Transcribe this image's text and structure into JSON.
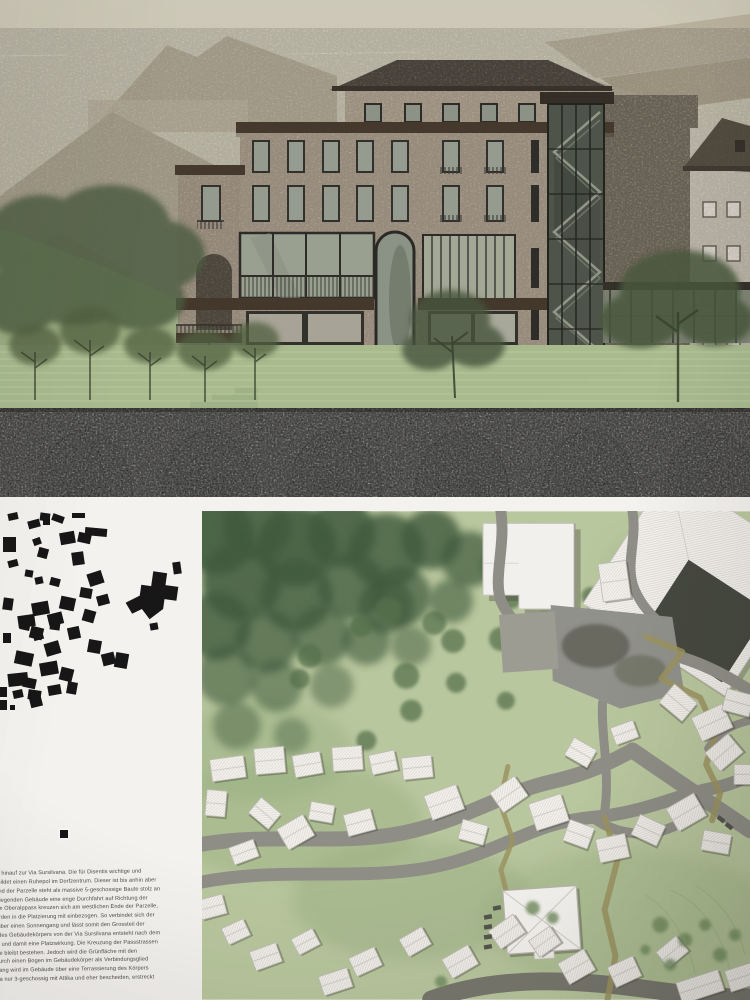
{
  "board": {
    "panels": {
      "top": "building-street-elevation-rendering",
      "bottom_left": "figure-ground-village-diagram",
      "bottom_right": "site-plan-rendering",
      "bottom_text": "project-description-german"
    }
  },
  "colors": {
    "sky": "#cac5b2",
    "stone_facade": "#b4a795",
    "cornice_dark": "#44392c",
    "window_glass": "#99a090",
    "terrace_green": "#a8ba8e",
    "stone_wall_dark": "#504f4a",
    "paper_white": "#f4f2ef",
    "plan_green": "#b9c79e",
    "forest_green": "#3f5a3c",
    "road_gray": "#8e8e86",
    "path_olive": "#9b9360",
    "figure_black": "#171717"
  },
  "description_text": {
    "lines": [
      "Hang hinauf zur Via Sursilvana. Die für Disentis wichtige und",
      "nen bildet einen Ruhepol im Dorfzentrum. Dieser ist bis anhin aber",
      "n Rand der Parzelle steht als massive 5-geschossige Baute stolz an",
      "überliegenden Gebäude eine enge Durchfahrt auf Richtung der",
      "d dem Oberalppass kreuzen sich am westlichen Ende der Parzelle,",
      "n werden in die Platzierung mit einbezogen. So verbindet sich der",
      "ess über einen Sonnengang und lässt somit den Grossteil der",
      "ung des Gebäudekörpers von der Via Sursilvana entsteht nach dem",
      "nung und damit eine Platzwirkung. Die Kreuzung der Passstrassen",
      "fläche bleibt bestehen. Jedoch wird die Grünfläche mit den",
      "hrt durch einen Bogen im Gebäudekörper als Verbindungsglied",
      "ile Hang wird im Gebäude über eine Terrassierung des Körpers",
      "ilvana nur 3-geschossig mit Attika und eher bescheiden, erstreckt",
      "sen."
    ]
  },
  "figure_ground": {
    "buildings": [
      [
        8,
        3,
        10,
        7,
        -12
      ],
      [
        40,
        3,
        10,
        8,
        8
      ],
      [
        52,
        5,
        12,
        7,
        20
      ],
      [
        72,
        3,
        13,
        5,
        0
      ],
      [
        28,
        10,
        12,
        8,
        -15
      ],
      [
        43,
        8,
        7,
        7,
        0
      ],
      [
        85,
        18,
        22,
        8,
        5
      ],
      [
        60,
        22,
        15,
        12,
        -10
      ],
      [
        78,
        23,
        13,
        10,
        12
      ],
      [
        3,
        27,
        13,
        15,
        0
      ],
      [
        33,
        28,
        8,
        7,
        -20
      ],
      [
        38,
        38,
        10,
        10,
        15
      ],
      [
        72,
        42,
        12,
        13,
        -8
      ],
      [
        8,
        50,
        10,
        7,
        -15
      ],
      [
        25,
        60,
        8,
        7,
        10
      ],
      [
        35,
        67,
        8,
        7,
        -12
      ],
      [
        50,
        68,
        10,
        8,
        15
      ],
      [
        88,
        62,
        15,
        13,
        -18
      ],
      [
        80,
        78,
        12,
        10,
        10
      ],
      [
        97,
        85,
        12,
        10,
        -15
      ],
      [
        60,
        87,
        15,
        13,
        12
      ],
      [
        32,
        92,
        17,
        13,
        -10
      ],
      [
        3,
        88,
        10,
        12,
        8
      ],
      [
        48,
        103,
        15,
        12,
        -14
      ],
      [
        83,
        100,
        12,
        12,
        16
      ],
      [
        18,
        105,
        17,
        12,
        -8
      ],
      [
        20,
        112,
        10,
        8,
        12
      ],
      [
        33,
        120,
        10,
        10,
        -15
      ],
      [
        50,
        112,
        10,
        8,
        8
      ],
      [
        150,
        113,
        8,
        7,
        -10
      ],
      [
        30,
        117,
        13,
        12,
        14
      ],
      [
        68,
        117,
        12,
        12,
        -12
      ],
      [
        3,
        123,
        8,
        10,
        0
      ],
      [
        45,
        132,
        15,
        13,
        -16
      ],
      [
        88,
        130,
        13,
        13,
        10
      ],
      [
        15,
        142,
        18,
        13,
        12
      ],
      [
        102,
        143,
        13,
        12,
        -14
      ],
      [
        115,
        143,
        13,
        15,
        10
      ],
      [
        40,
        152,
        18,
        13,
        -10
      ],
      [
        60,
        158,
        13,
        13,
        14
      ],
      [
        8,
        163,
        20,
        13,
        -6
      ],
      [
        67,
        172,
        10,
        12,
        10
      ],
      [
        12,
        165,
        10,
        8,
        -18
      ],
      [
        23,
        168,
        13,
        10,
        12
      ],
      [
        48,
        175,
        13,
        10,
        -10
      ],
      [
        28,
        180,
        13,
        10,
        8
      ],
      [
        13,
        180,
        10,
        8,
        -12
      ],
      [
        0,
        177,
        7,
        10,
        0
      ],
      [
        30,
        187,
        12,
        10,
        -14
      ],
      [
        0,
        190,
        7,
        10,
        0
      ],
      [
        10,
        195,
        5,
        5,
        0
      ],
      [
        173,
        52,
        8,
        12,
        -8
      ]
    ],
    "landmark_path": "M150,62 h14 v12 h13 v14 h-12 v10 l-12,12 -9,-9 -9,6 -8,-10 13,-9 v-11 h10 z",
    "landmark_rotation": 8
  },
  "site_plan": {
    "forest": [
      [
        15,
        25,
        38,
        0.9
      ],
      [
        55,
        15,
        34,
        0.85
      ],
      [
        95,
        35,
        40,
        0.9
      ],
      [
        140,
        22,
        34,
        0.85
      ],
      [
        185,
        40,
        38,
        0.8
      ],
      [
        230,
        28,
        30,
        0.8
      ],
      [
        268,
        48,
        28,
        0.7
      ],
      [
        40,
        70,
        40,
        0.85
      ],
      [
        95,
        85,
        36,
        0.8
      ],
      [
        150,
        75,
        34,
        0.75
      ],
      [
        200,
        85,
        30,
        0.7
      ],
      [
        15,
        115,
        34,
        0.8
      ],
      [
        65,
        130,
        32,
        0.7
      ],
      [
        120,
        125,
        30,
        0.65
      ],
      [
        25,
        165,
        30,
        0.6
      ],
      [
        75,
        175,
        26,
        0.55
      ],
      [
        165,
        130,
        24,
        0.6
      ],
      [
        250,
        90,
        22,
        0.6
      ],
      [
        300,
        55,
        20,
        0.55
      ],
      [
        330,
        35,
        18,
        0.5
      ],
      [
        210,
        135,
        20,
        0.5
      ],
      [
        130,
        175,
        22,
        0.45
      ],
      [
        35,
        215,
        24,
        0.45
      ],
      [
        90,
        225,
        18,
        0.4
      ],
      [
        185,
        95,
        28,
        0.7
      ]
    ],
    "mid_trees": [
      [
        187,
        100,
        14
      ],
      [
        233,
        112,
        12
      ],
      [
        205,
        165,
        13
      ],
      [
        252,
        130,
        12
      ],
      [
        160,
        115,
        11
      ],
      [
        108,
        145,
        12
      ],
      [
        98,
        168,
        10
      ],
      [
        300,
        128,
        12
      ],
      [
        345,
        112,
        11
      ],
      [
        310,
        88,
        10
      ],
      [
        350,
        60,
        12
      ],
      [
        390,
        85,
        9
      ],
      [
        255,
        172,
        10
      ],
      [
        210,
        200,
        11
      ],
      [
        165,
        230,
        10
      ],
      [
        305,
        190,
        9
      ]
    ],
    "light_trees": [
      [
        332,
        398,
        7
      ],
      [
        352,
        408,
        6
      ],
      [
        460,
        415,
        8
      ],
      [
        485,
        430,
        7
      ],
      [
        505,
        415,
        6
      ],
      [
        520,
        445,
        7
      ],
      [
        470,
        455,
        6
      ],
      [
        445,
        440,
        5
      ],
      [
        240,
        472,
        6
      ],
      [
        535,
        425,
        6
      ]
    ],
    "roads": [
      {
        "d": "M550,180 C510,154 468,138 438,141 C412,143 402,152 386,160",
        "w": 12
      },
      {
        "d": "M438,141 C418,132 396,136 388,151 C380,166 392,180 409,179 C426,178 433,165 428,153",
        "w": 10
      },
      {
        "d": "M432,0 C437,28 424,54 434,78 C441,94 450,104 460,112",
        "w": 10
      },
      {
        "d": "M352,132 C330,124 310,112 301,92 C291,70 305,36 300,0",
        "w": 11
      },
      {
        "d": "M0,334 C70,322 140,336 205,322 C268,308 302,282 352,271 C392,262 412,250 432,240",
        "w": 15
      },
      {
        "d": "M0,372 C80,356 162,372 236,356 C300,342 332,312 392,307 C442,303 472,286 512,278 C532,274 544,268 550,263",
        "w": 13
      },
      {
        "d": "M392,307 C420,329 462,329 492,305",
        "w": 10
      },
      {
        "d": "M432,240 C470,266 520,300 550,320",
        "w": 16
      },
      {
        "d": "M402,192 C400,222 410,262 404,302",
        "w": 9
      },
      {
        "d": "M230,490 C300,464 380,470 458,481 C502,487 532,488 550,488",
        "w": 18,
        "c": "#77776e"
      },
      {
        "d": "M550,210 C530,214 516,224 508,238",
        "w": 8
      }
    ],
    "olive_paths": [
      {
        "d": "M446,126 L482,141 L461,168 L500,187 L516,222 L506,254 L520,283 L512,310",
        "w": 6
      },
      {
        "d": "M307,256 L299,292 L312,330 L300,360 L306,384",
        "w": 5
      },
      {
        "d": "M404,307 L417,350 L404,400 L415,446 L407,490",
        "w": 6
      }
    ],
    "buildings": [
      [
        26,
        258,
        34,
        22,
        -8
      ],
      [
        68,
        250,
        30,
        26,
        -5
      ],
      [
        106,
        254,
        28,
        22,
        -10
      ],
      [
        146,
        248,
        30,
        24,
        -4
      ],
      [
        182,
        252,
        26,
        20,
        -12
      ],
      [
        216,
        257,
        30,
        22,
        -6
      ],
      [
        14,
        293,
        20,
        26,
        5
      ],
      [
        63,
        303,
        26,
        20,
        40
      ],
      [
        94,
        322,
        30,
        24,
        -30
      ],
      [
        120,
        302,
        24,
        18,
        10
      ],
      [
        158,
        312,
        28,
        22,
        -15
      ],
      [
        42,
        342,
        26,
        18,
        -20
      ],
      [
        243,
        292,
        34,
        26,
        -20
      ],
      [
        272,
        322,
        26,
        20,
        15
      ],
      [
        308,
        284,
        30,
        24,
        -35
      ],
      [
        348,
        302,
        34,
        28,
        -18
      ],
      [
        378,
        324,
        26,
        22,
        20
      ],
      [
        412,
        338,
        30,
        24,
        -12
      ],
      [
        448,
        320,
        28,
        22,
        25
      ],
      [
        486,
        302,
        32,
        26,
        -30
      ],
      [
        516,
        332,
        28,
        20,
        10
      ],
      [
        478,
        192,
        30,
        24,
        40
      ],
      [
        512,
        212,
        34,
        26,
        -25
      ],
      [
        538,
        192,
        28,
        22,
        15
      ],
      [
        524,
        242,
        30,
        24,
        -40
      ],
      [
        547,
        264,
        26,
        20,
        0
      ],
      [
        380,
        242,
        26,
        20,
        30
      ],
      [
        424,
        222,
        24,
        18,
        -20
      ],
      [
        414,
        70,
        28,
        38,
        -8
      ],
      [
        306,
        422,
        30,
        22,
        -35
      ],
      [
        344,
        432,
        26,
        20,
        -35
      ],
      [
        376,
        457,
        30,
        24,
        -30
      ],
      [
        424,
        462,
        28,
        22,
        -25
      ],
      [
        472,
        442,
        26,
        20,
        -40
      ],
      [
        259,
        452,
        30,
        22,
        -30
      ],
      [
        214,
        432,
        26,
        20,
        -30
      ],
      [
        164,
        452,
        28,
        20,
        -25
      ],
      [
        10,
        397,
        26,
        20,
        -15
      ],
      [
        34,
        422,
        24,
        18,
        -25
      ],
      [
        64,
        447,
        28,
        20,
        -20
      ],
      [
        104,
        432,
        24,
        18,
        -28
      ],
      [
        134,
        472,
        30,
        20,
        -18
      ],
      [
        500,
        477,
        44,
        22,
        -18
      ],
      [
        543,
        467,
        32,
        22,
        -18
      ]
    ],
    "cars": [
      [
        287,
        407,
        -10
      ],
      [
        287,
        417,
        -10
      ],
      [
        287,
        427,
        -8
      ],
      [
        287,
        437,
        -10
      ],
      [
        521,
        309,
        38
      ],
      [
        529,
        316,
        38
      ],
      [
        296,
        398,
        -12
      ]
    ]
  }
}
